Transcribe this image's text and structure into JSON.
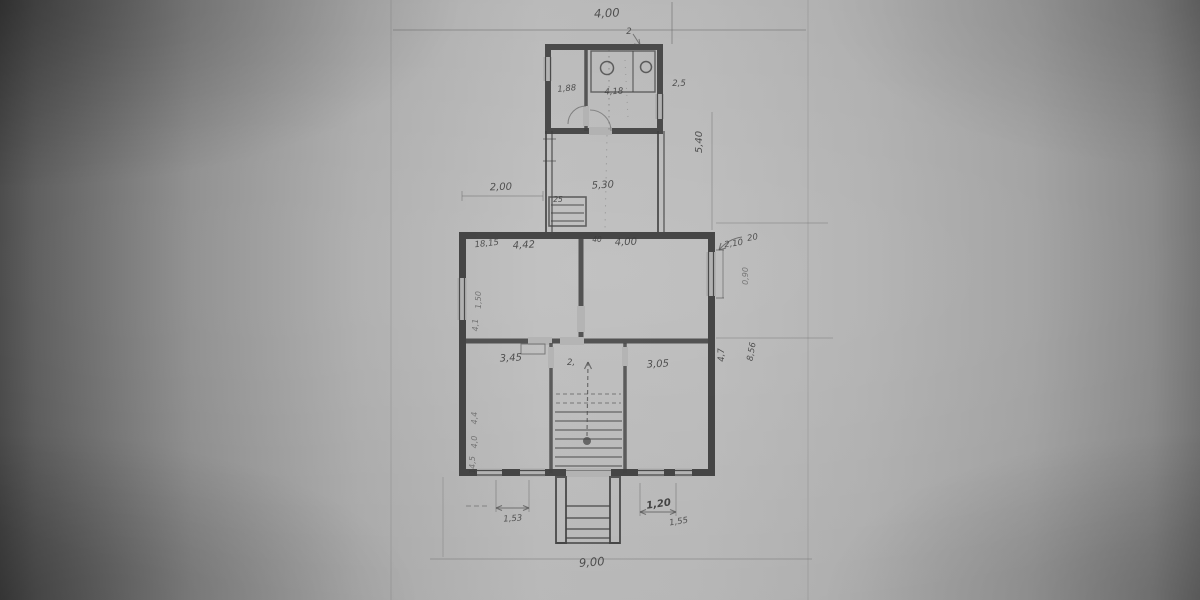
{
  "palette": {
    "paper": "#b6b6b6",
    "ink": "#3d3d3d",
    "pencil": "#6e6e6e"
  },
  "annotations": {
    "top_width": "4,00",
    "top_note": "2",
    "annex_room_left": "1,88",
    "annex_room_right": "4,18",
    "annex_side_note": "2,5",
    "yard_gap": "2,00",
    "yard_width": "5,30",
    "back_steps_note": "25",
    "passage_side_dim": "5,40",
    "corner_note": "18,15",
    "room_top_left": "4,42",
    "partition_note": "40",
    "room_top_right": "4,00",
    "window_note_a": "20",
    "window_note_b": "2,10",
    "window_right_dim": "0,90",
    "room_bottom_left": "3,45",
    "stair_hall": "2,",
    "room_bottom_right": "3,05",
    "side_depth_lower": "4,7",
    "side_depth_total": "8,56",
    "left_dim_a": "1,50",
    "left_dim_b": "4,1",
    "left_dim_c": "4,4",
    "left_dim_d": "4,0",
    "left_dim_e": "14,5",
    "bottom_dim_left": "1,53",
    "bottom_dim_right_a": "1,20",
    "bottom_dim_right_b": "1,55",
    "bottom_width": "9,00"
  }
}
